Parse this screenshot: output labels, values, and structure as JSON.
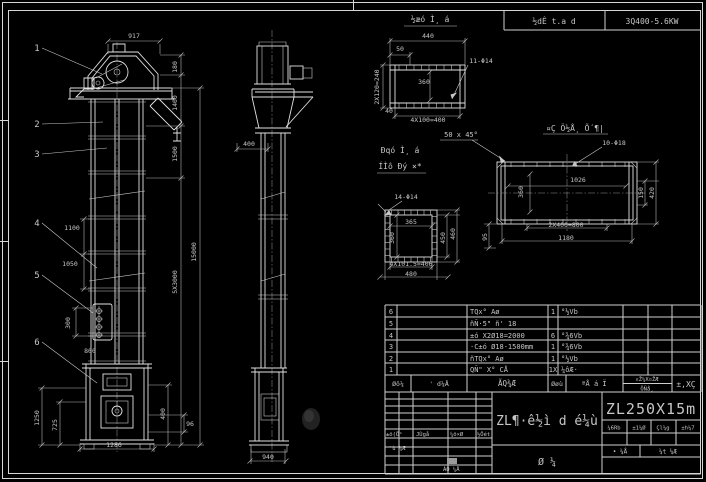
{
  "meta": {
    "background": "#000000",
    "line_color": "#e2e2e2",
    "dim_color": "#b5b5b5",
    "text_color": "#c6c6c6",
    "highlight_cell_color": "#9a9a9a"
  },
  "header": {
    "title_cell": "½dÊ t.a d",
    "number_cell": "3Q400-5.6KW"
  },
  "detail_titles": {
    "flange_top": "½æó Ì¸ á",
    "flange_side_1": "Ðqó Ì¸ á",
    "flange_side_2": "ÍÌô Ðý ×*",
    "plate": "¤Ç Ö½Å¸ Õ´¶|",
    "chamfer_note": "50 x 45°"
  },
  "callouts": [
    {
      "n": "1",
      "tx": 37,
      "ty": 51,
      "lx": 102,
      "ly": 74
    },
    {
      "n": "2",
      "tx": 37,
      "ty": 127,
      "lx": 103,
      "ly": 122
    },
    {
      "n": "3",
      "tx": 37,
      "ty": 157,
      "lx": 107,
      "ly": 148
    },
    {
      "n": "4",
      "tx": 37,
      "ty": 226,
      "lx": 97,
      "ly": 268
    },
    {
      "n": "5",
      "tx": 37,
      "ty": 278,
      "lx": 93,
      "ly": 313
    },
    {
      "n": "6",
      "tx": 37,
      "ty": 345,
      "lx": 97,
      "ly": 383
    }
  ],
  "dim_labels": [
    {
      "t": "917",
      "x": 134,
      "y": 38
    },
    {
      "t": "180",
      "x": 177,
      "y": 67,
      "r": -90
    },
    {
      "t": "1400",
      "x": 177,
      "y": 103,
      "r": -90
    },
    {
      "t": "1500",
      "x": 177,
      "y": 154,
      "r": -90
    },
    {
      "t": "5X3000",
      "x": 177,
      "y": 282,
      "r": -90
    },
    {
      "t": "15000",
      "x": 196,
      "y": 252,
      "r": -90
    },
    {
      "t": "1100",
      "x": 72,
      "y": 230
    },
    {
      "t": "1050",
      "x": 70,
      "y": 266
    },
    {
      "t": "300",
      "x": 70,
      "y": 323,
      "r": -90
    },
    {
      "t": "800",
      "x": 90,
      "y": 353
    },
    {
      "t": "1250",
      "x": 39,
      "y": 418,
      "r": -90
    },
    {
      "t": "725",
      "x": 57,
      "y": 425,
      "r": -90
    },
    {
      "t": "400",
      "x": 165,
      "y": 414,
      "r": -90
    },
    {
      "t": "96",
      "x": 190,
      "y": 426
    },
    {
      "t": "1286",
      "x": 114,
      "y": 447
    },
    {
      "t": "400",
      "x": 249,
      "y": 146
    },
    {
      "t": "940",
      "x": 268,
      "y": 459
    },
    {
      "t": "440",
      "x": 428,
      "y": 38
    },
    {
      "t": "50",
      "x": 400,
      "y": 51
    },
    {
      "t": "11-Φ14",
      "x": 481,
      "y": 63
    },
    {
      "t": "2X120=240",
      "x": 379,
      "y": 87,
      "r": -90
    },
    {
      "t": "360",
      "x": 424,
      "y": 84
    },
    {
      "t": "40",
      "x": 389,
      "y": 113
    },
    {
      "t": "4X100=400",
      "x": 428,
      "y": 122
    },
    {
      "t": "14-Φ14",
      "x": 406,
      "y": 199
    },
    {
      "t": "365",
      "x": 411,
      "y": 224
    },
    {
      "t": "360",
      "x": 394,
      "y": 238,
      "r": -90
    },
    {
      "t": "450",
      "x": 445,
      "y": 238,
      "r": -90
    },
    {
      "t": "460",
      "x": 455,
      "y": 234,
      "r": -90
    },
    {
      "t": "4X101.5=406",
      "x": 411,
      "y": 266
    },
    {
      "t": "480",
      "x": 411,
      "y": 276
    },
    {
      "t": "10-Φ18",
      "x": 614,
      "y": 145
    },
    {
      "t": "1026",
      "x": 578,
      "y": 182
    },
    {
      "t": "360",
      "x": 523,
      "y": 192,
      "r": -90
    },
    {
      "t": "150",
      "x": 643,
      "y": 193,
      "r": -90
    },
    {
      "t": "420",
      "x": 654,
      "y": 193,
      "r": -90
    },
    {
      "t": "2X400=800",
      "x": 566,
      "y": 227
    },
    {
      "t": "1180",
      "x": 566,
      "y": 240
    },
    {
      "t": "95",
      "x": 487,
      "y": 237,
      "r": -90
    }
  ],
  "bom": {
    "header": {
      "no": "Øô¼",
      "code": "' d¼Å",
      "name": "ÃQ¾Æ",
      "qty": "Øøù",
      "mat": "ªÅ á Ï",
      "weight_top": "¤Ž¼X¤ŽÆ",
      "weight_bottom": "ÖÑå¸",
      "note": "±‚XÇ"
    },
    "rows": [
      {
        "no": "6",
        "code": "",
        "name": "TQx° Aø",
        "qty": "1",
        "mat": "°½Vb"
      },
      {
        "no": "5",
        "code": "",
        "name": "ñÑ·5\" ñ' 18",
        "qty": "",
        "mat": ""
      },
      {
        "no": "4",
        "code": "",
        "name": "±ó X2Ø18=2000",
        "qty": "6",
        "mat": "°¾6Vb"
      },
      {
        "no": "3",
        "code": "",
        "name": "·C±ó Ø18-1500mm",
        "qty": "1",
        "mat": "°¾6Vb"
      },
      {
        "no": "2",
        "code": "",
        "name": "ñTQx° Aø",
        "qty": "1",
        "mat": "°½Vb"
      },
      {
        "no": "1",
        "code": "",
        "name": "QÑ\" X° CÅ",
        "qty": "1X",
        "mat": "¼ôÆ·"
      }
    ]
  },
  "title_block": {
    "drawing_name": "ZL¶·ê½ì d é¼ù",
    "drawing_type": "Ø  ¼",
    "model": "ZL250X15m",
    "rev_header": [
      "±ö(Ö¹",
      "JÙgå",
      "¼ö×Ø",
      "½Öét"
    ],
    "rev_row2": "'ù ¼Æ",
    "rev_row3": "ÀÕ ¼Å",
    "right_cells": [
      "¼6Rb",
      "±1¼Ø",
      "Çl¼g",
      "±h¼7"
    ],
    "sheet_row": [
      "• ¼Å",
      "¼t ¼Æ"
    ]
  }
}
